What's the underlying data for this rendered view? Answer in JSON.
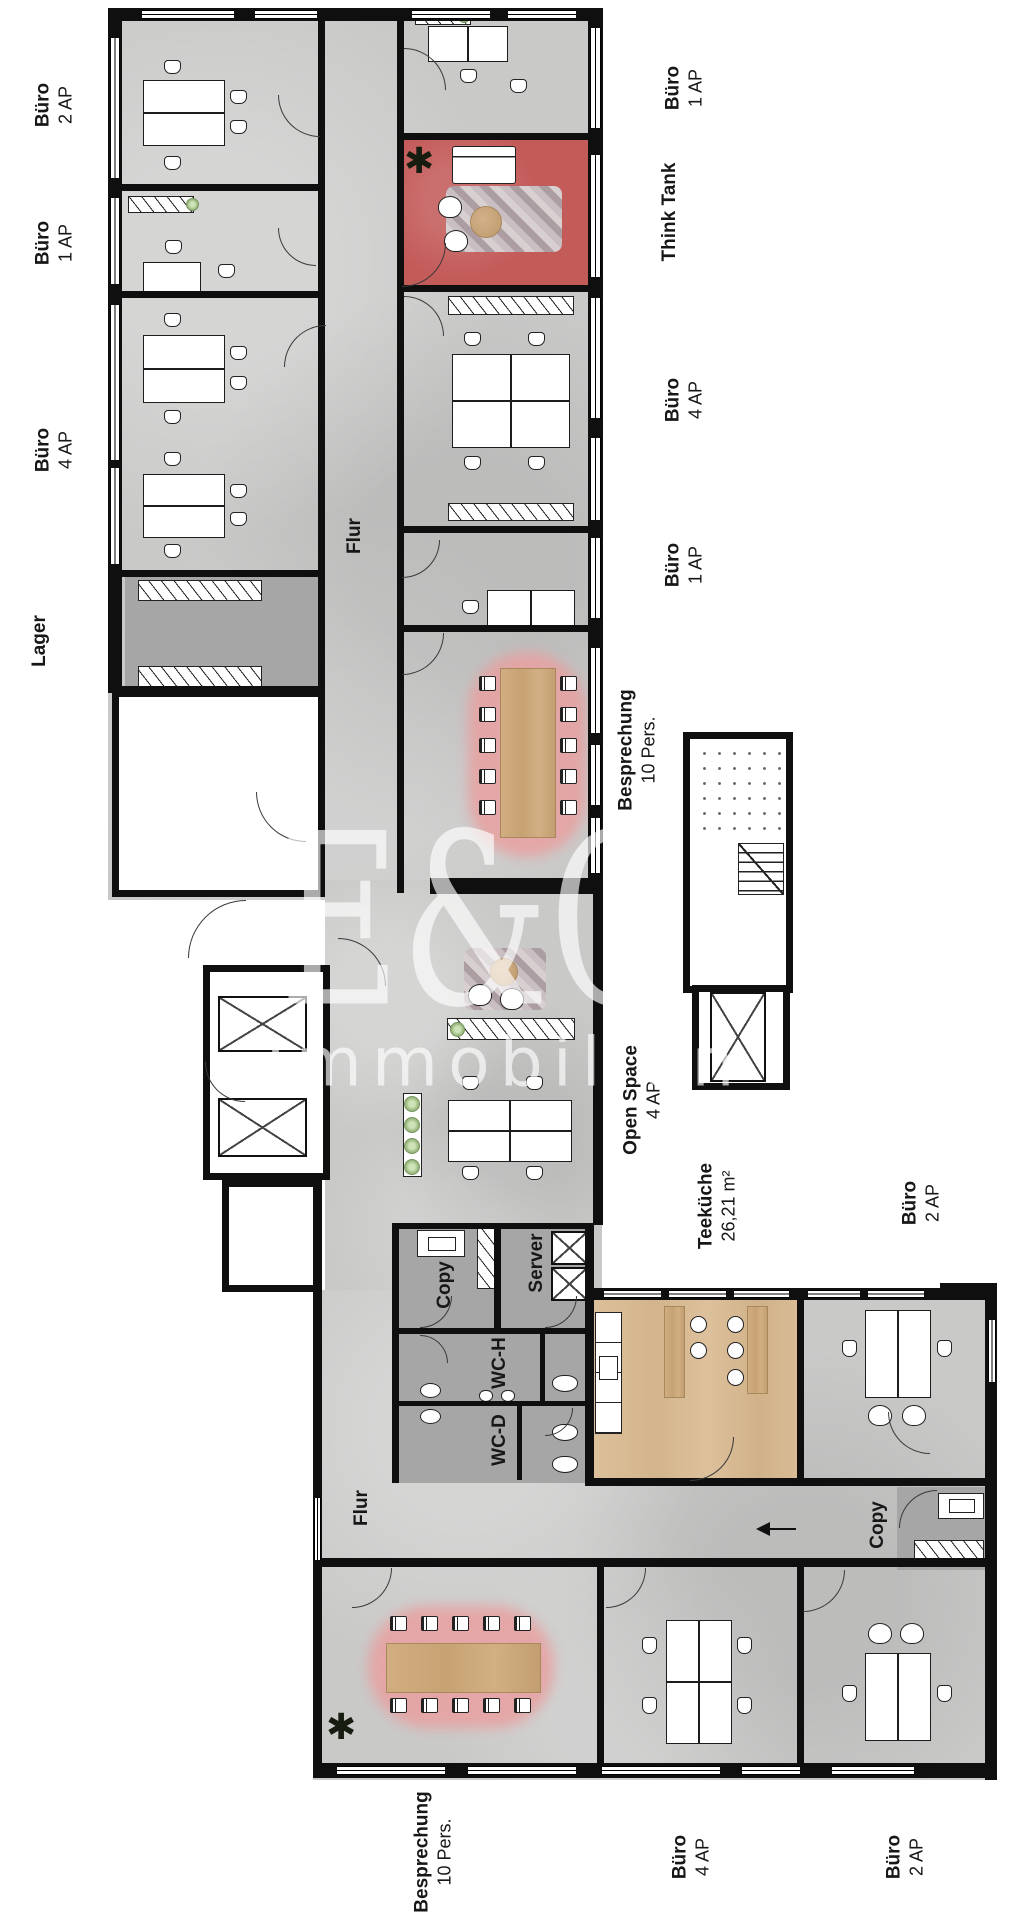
{
  "watermark": {
    "line1": "E&C",
    "line2": "Immobilien"
  },
  "icons": {
    "plant": "✱"
  },
  "colors": {
    "floor": "#c9c9c8",
    "service_floor": "#a6a6a6",
    "think_tank_floor": "#c35b59",
    "kitchen_floor": "#d8bb95",
    "meeting_highlight": "#e9a0a0",
    "wall": "#0f0f0f"
  },
  "labels": {
    "buero_2ap_nw": {
      "name": "Büro",
      "detail": "2 AP"
    },
    "buero_1ap_w": {
      "name": "Büro",
      "detail": "1 AP"
    },
    "buero_4ap_w": {
      "name": "Büro",
      "detail": "4 AP"
    },
    "lager": {
      "name": "Lager"
    },
    "buero_1ap_ne": {
      "name": "Büro",
      "detail": "1 AP"
    },
    "think_tank": {
      "name": "Think Tank"
    },
    "buero_4ap_e": {
      "name": "Büro",
      "detail": "4 AP"
    },
    "buero_1ap_e": {
      "name": "Büro",
      "detail": "1 AP"
    },
    "besprechung_e": {
      "name": "Besprechung",
      "detail": "10 Pers."
    },
    "flur_upper": {
      "name": "Flur"
    },
    "open_space": {
      "name": "Open Space",
      "detail": "4 AP"
    },
    "teekueche": {
      "name": "Teeküche",
      "detail": "26,21 m²"
    },
    "buero_2ap_e": {
      "name": "Büro",
      "detail": "2 AP"
    },
    "copy_upper": {
      "name": "Copy"
    },
    "server": {
      "name": "Server"
    },
    "wc_h": {
      "name": "WC-H"
    },
    "wc_d": {
      "name": "WC-D"
    },
    "flur_lower": {
      "name": "Flur"
    },
    "copy_lower": {
      "name": "Copy"
    },
    "besprechung_s": {
      "name": "Besprechung",
      "detail": "10 Pers."
    },
    "buero_4ap_s": {
      "name": "Büro",
      "detail": "4 AP"
    },
    "buero_2ap_s": {
      "name": "Büro",
      "detail": "2 AP"
    }
  }
}
